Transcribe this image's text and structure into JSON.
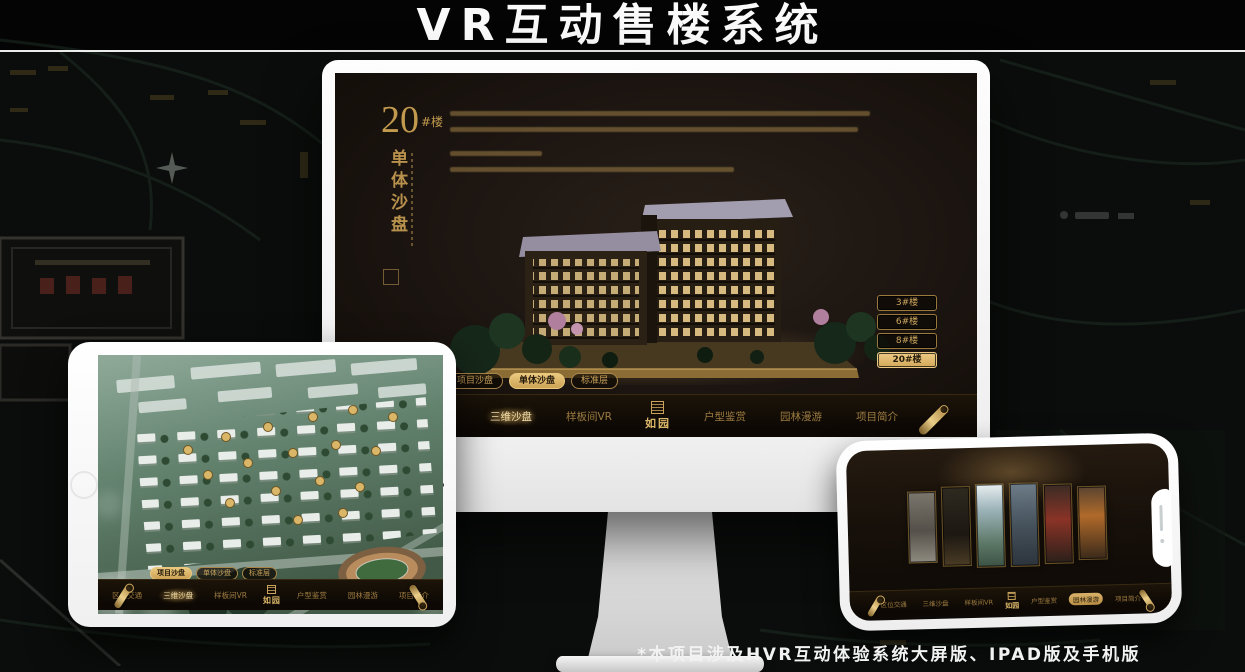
{
  "page": {
    "title": "VR互动售楼系统",
    "footnote": "*本项目涉及HVR互动体验系统大屏版、IPAD版及手机版"
  },
  "app": {
    "brand": "如园",
    "nav_items": [
      "区位交通",
      "三维沙盘",
      "样板间VR",
      "户型鉴赏",
      "园林漫游",
      "项目简介"
    ],
    "sub_tabs": [
      "项目沙盘",
      "单体沙盘",
      "标准层"
    ]
  },
  "monitor": {
    "unit_number": "20",
    "unit_suffix": "#楼",
    "section_title": "单体沙盘",
    "building_buttons": [
      "3#楼",
      "6#楼",
      "8#楼",
      "20#楼"
    ],
    "active_building": "20#楼",
    "active_sub_tab": "单体沙盘",
    "active_nav_item": "三维沙盘"
  },
  "tablet": {
    "active_sub_tab": "项目沙盘",
    "active_nav_item": "三维沙盘"
  },
  "phone": {
    "active_nav_item": "园林漫游"
  },
  "colors": {
    "gold": "#c9a35b",
    "gold_bright": "#e8c87c",
    "screen_bg": "#1a1410",
    "nav_bg": "#120c06",
    "title_text": "#fafafa"
  }
}
